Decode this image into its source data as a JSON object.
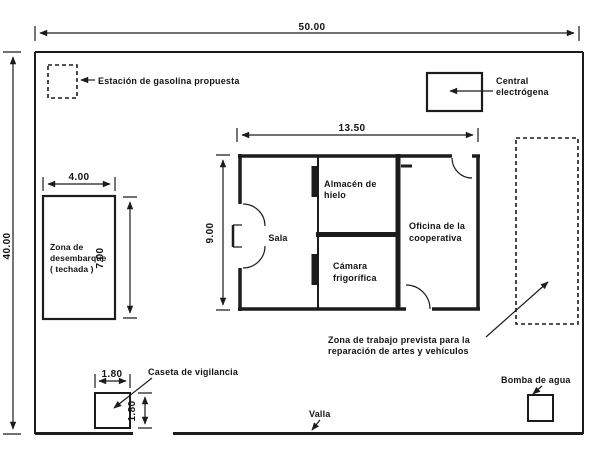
{
  "site": {
    "width": "50.00",
    "height": "40.00",
    "fence_label": "Valla"
  },
  "gas_station": {
    "label": "Estación de gasolina propuesta"
  },
  "power_plant": {
    "line1": "Central",
    "line2": "electrógena"
  },
  "building": {
    "width": "13.50",
    "height": "9.00",
    "rooms": {
      "sala": {
        "label": "Sala"
      },
      "almacen": {
        "line1": "Almacén de",
        "line2": "hielo"
      },
      "camara": {
        "line1": "Cámara",
        "line2": "frigorífica"
      },
      "oficina": {
        "line1": "Oficina de la",
        "line2": "cooperativa"
      }
    }
  },
  "unloading_zone": {
    "line1": "Zona de",
    "line2": "desembarque",
    "line3": "( techada )",
    "width": "4.00",
    "height": "7.00"
  },
  "guard_house": {
    "label": "Caseta de vigilancia",
    "width": "1.80",
    "height": "1.80"
  },
  "water_pump": {
    "label": "Bomba de agua"
  },
  "work_zone": {
    "line1": "Zona de trabajo prevista para la",
    "line2": "reparación de artes y vehículos"
  },
  "colors": {
    "ink": "#1c1c1c",
    "paper": "#ffffff"
  }
}
